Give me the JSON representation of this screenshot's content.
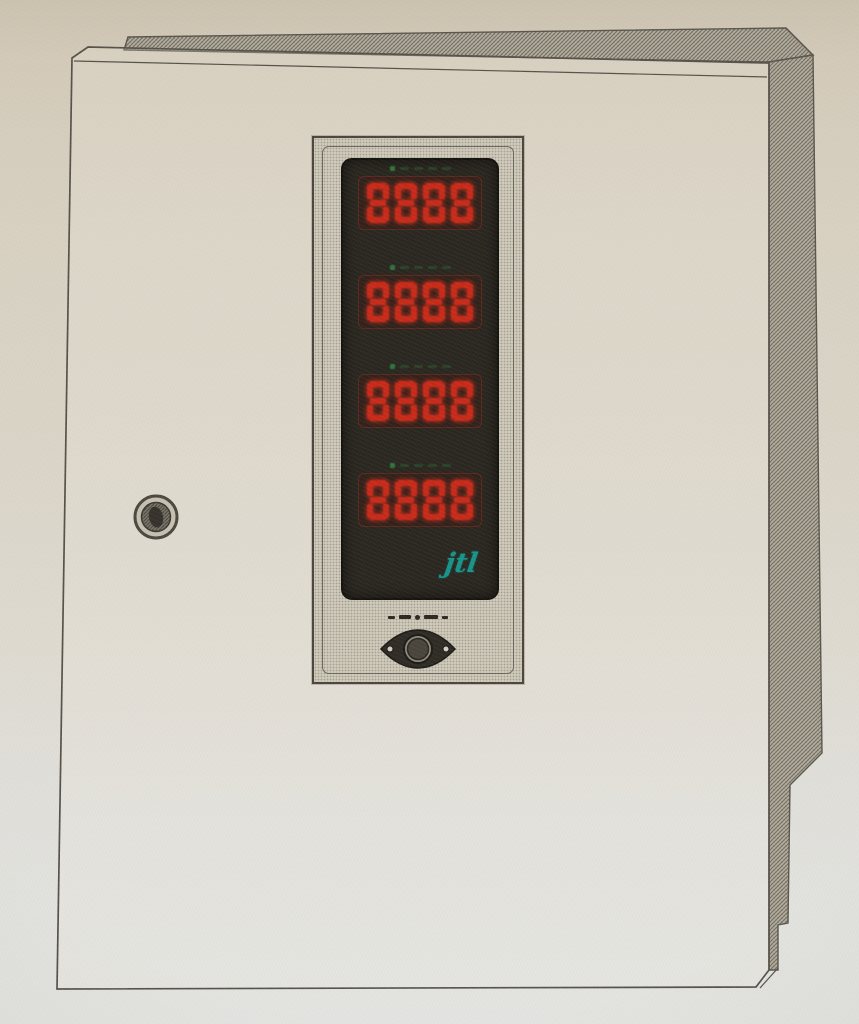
{
  "display": {
    "rows": [
      {
        "value": "8888"
      },
      {
        "value": "8888"
      },
      {
        "value": "8888"
      },
      {
        "value": "8888"
      }
    ],
    "logo_text": "jtl"
  },
  "colors": {
    "digit_red": "#c62a1a",
    "indicator_green": "#2f8a40",
    "logo_teal": "#17948a",
    "display_black": "#29251f",
    "bezel_gray": "#cfcaba",
    "paper_beige": "#d8d1c2",
    "line_ink": "#56524a"
  },
  "icons": {
    "door_lock": "round-cylinder-lock",
    "panel_knob": "diamond-latch-knob"
  }
}
